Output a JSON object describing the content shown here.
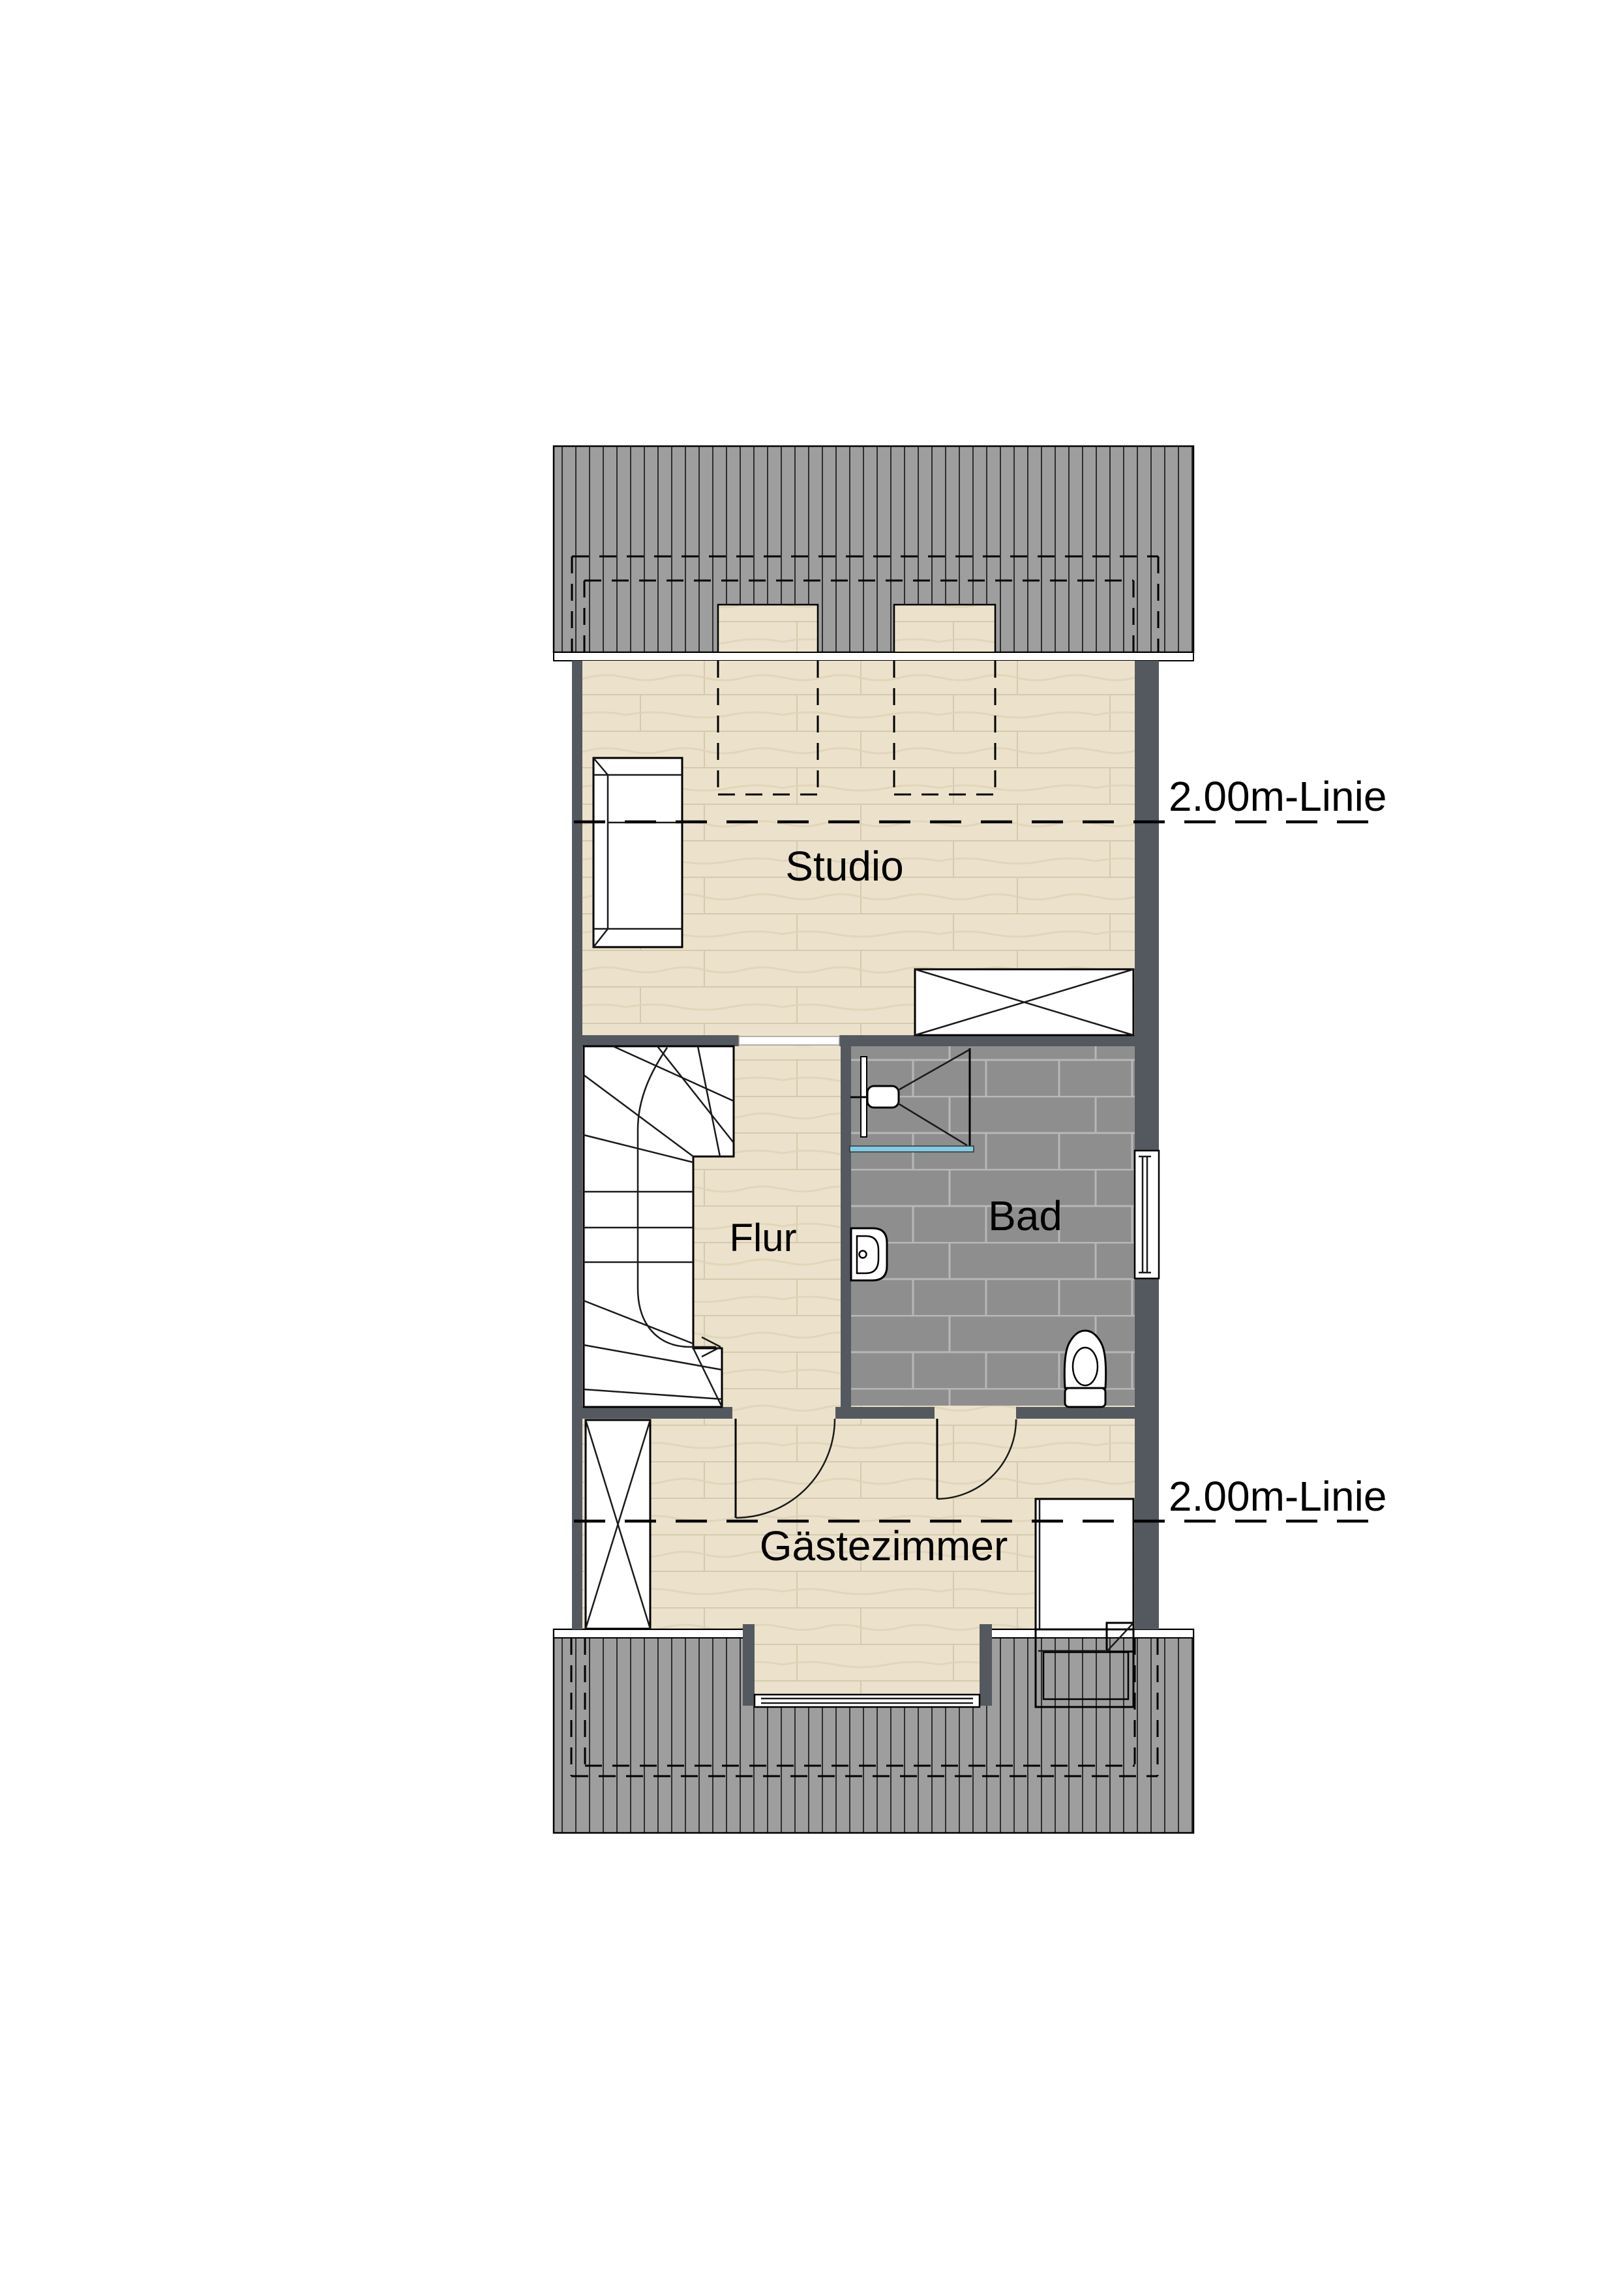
{
  "plan": {
    "title": "Dachgeschoss Grundriss",
    "rooms": [
      {
        "id": "studio",
        "label": "Studio"
      },
      {
        "id": "flur",
        "label": "Flur"
      },
      {
        "id": "bad",
        "label": "Bad"
      },
      {
        "id": "gaestezimmer",
        "label": "Gästezimmer"
      }
    ],
    "annotations": {
      "height_line_top": "2.00m-Linie",
      "height_line_bottom": "2.00m-Linie"
    },
    "colors": {
      "wall": "#54595f",
      "roof": "#9e9e9e",
      "roof_line": "#2e2e2e",
      "wood": "#ece2cb",
      "wood_line": "#d5caad",
      "wood_grain": "#ded3b6",
      "tile": "#8e8e8e",
      "tile_line": "#b7b7b7",
      "shower_drain": "#7fcde4"
    }
  }
}
